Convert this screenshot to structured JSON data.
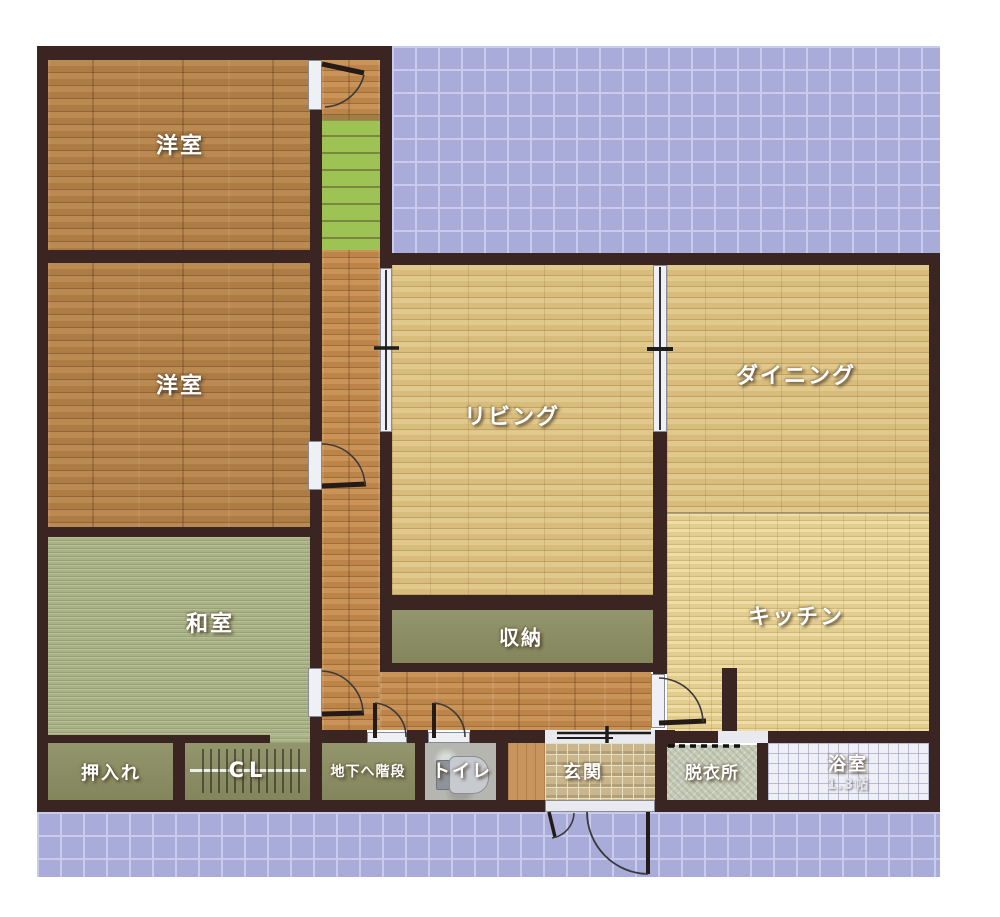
{
  "plan_type": "floor-plan",
  "rooms": {
    "yoshitsu1": "洋室",
    "yoshitsu2": "洋室",
    "washitsu": "和室",
    "living": "リビング",
    "dining": "ダイニング",
    "kitchen": "キッチン",
    "shunou": "収納",
    "oshiire": "押入れ",
    "closet": "CL",
    "basement_stairs": "地下へ階段",
    "toilet": "トイレ",
    "genkan": "玄関",
    "datsuijo": "脱衣所",
    "bathroom": "浴室",
    "bathroom_size": "1.3帖"
  },
  "palette": {
    "wall": "#3a2522",
    "balcony_tile": "#a9acd9",
    "wood_dark": "#b2804a",
    "wood_corridor": "#c28d55",
    "wood_light": "#dcc185",
    "wood_kitchen": "#e5d192",
    "tatami": "#a9b285",
    "stairs": "#9dc355",
    "closet_floor": "#8b8e61",
    "bath_tile": "#eff0f5",
    "genkan_tile": "#c9b68c",
    "label_text": "#ffffff"
  }
}
